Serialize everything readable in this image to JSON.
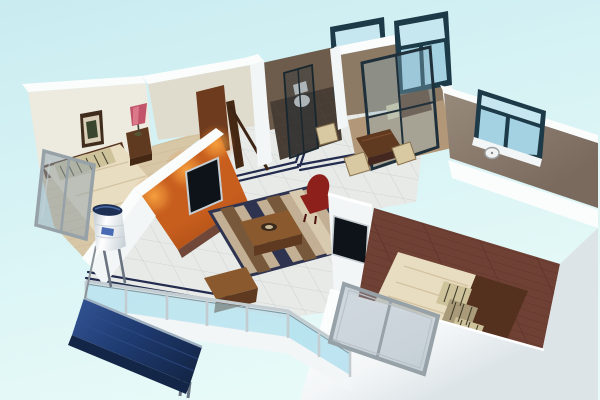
{
  "scene": {
    "type": "3d-isometric-apartment-floorplan-render",
    "view": "aerial-cutaway",
    "background": "pale-cyan",
    "rooms": [
      {
        "id": "master-bedroom",
        "objects": [
          "double-bed",
          "striped-pillows",
          "dark-headboard",
          "nightstand",
          "pink-table-lamp",
          "framed-picture"
        ]
      },
      {
        "id": "living-room",
        "objects": [
          "orange-feature-wall",
          "recessed-tv",
          "accent-spotlights",
          "striped-rug",
          "coffee-table",
          "decor-bowl",
          "red-armchair",
          "wooden-bench",
          "navy-floor-inlay"
        ]
      },
      {
        "id": "bathroom",
        "objects": [
          "toilet",
          "glass-shower-partition",
          "window"
        ]
      },
      {
        "id": "kitchen",
        "objects": [
          "glass-partition-door",
          "counter",
          "window"
        ]
      },
      {
        "id": "dining-area",
        "objects": [
          "dark-wood-table",
          "beige-chairs",
          "stool"
        ]
      },
      {
        "id": "top-right-bedroom",
        "objects": [
          "window",
          "wall-clock"
        ]
      },
      {
        "id": "bottom-right-bedroom",
        "objects": [
          "double-bed",
          "striped-pillows",
          "wall-tv",
          "wood-floor",
          "leaning-window"
        ]
      },
      {
        "id": "balcony",
        "objects": [
          "glass-railing",
          "solar-panel",
          "solar-water-tank",
          "leaning-window"
        ]
      }
    ]
  },
  "palette": {
    "bg_top": "#c9ecf1",
    "bg_bottom": "#e7faf8",
    "wall_bright": "#fbfdfd",
    "wall_white": "#f3f6f7",
    "wall_shade": "#dde4e8",
    "wall_ivory": "#edeadf",
    "wall_ivory_shade": "#e0dccd",
    "taupe_bath": "#6d5c4c",
    "taupe_kitchen": "#8c7a64",
    "taupe_right": "#968879",
    "taupe_right_dark": "#7a6a5e",
    "orange_base": "#c75e1e",
    "orange_lit": "#f7a13f",
    "orange_deep": "#9e4612",
    "orange_base_strip": "#5a2a1a",
    "navy_inlay": "#232c4e",
    "window_frame": "#1d3a48",
    "window_glass": "#a4d2e2",
    "window_glass_light": "#c6e7f0",
    "balcony_glass": "#aadcec",
    "rail_silver": "#c3ccd1",
    "rail_dark": "#7e949c",
    "panel_navy": "#1e3a6f",
    "panel_navy_light": "#2f4f8e",
    "panel_edge": "#142647",
    "tank_white": "#f1f4f5",
    "tank_shade": "#c9d2d8",
    "tank_cap": "#1d3054",
    "tank_label": "#2a52a8",
    "tile": "#e8eae8",
    "grout": "#c8cecf",
    "carpet": "#d8c7a6",
    "carpet_line": "#c4b190",
    "wood_floor": "#6f4034",
    "wood_dark": "#4e2820",
    "bath_floor": "#473d34",
    "kitchen_floor": "#b29878",
    "rug_base": "#c3b094",
    "rug_dark": "#2e3450",
    "rug_brown": "#77583a",
    "rug_cream": "#d8caae",
    "duvet": "#e9ddc1",
    "duvet_line": "#d2c2a0",
    "pillow": "#cec29b",
    "pillow_mid": "#a99b79",
    "pillow_stripe": "#423e2e",
    "headboard": "#54311f",
    "furniture_brown": "#8a5a2e",
    "furniture_dark": "#5f3a20",
    "chair_red": "#8e201c",
    "chair_red_dark": "#6d1512",
    "chair_beige": "#d8c9a2",
    "door_brown": "#6e3b1e",
    "frame_wood_dark": "#442814",
    "lamp_pink": "#c2556a",
    "lamp_pink_light": "#e58798",
    "picture_frame": "#3f2c1c",
    "picture_mat": "#d9cfb8",
    "picture_art": "#39452e",
    "tv_screen": "#0d1318",
    "tv_frame": "#c7ced2",
    "gray_frame": "#96a1a8",
    "gray_glass": "#8fa3b0",
    "clock_white": "#f2f4f4"
  }
}
